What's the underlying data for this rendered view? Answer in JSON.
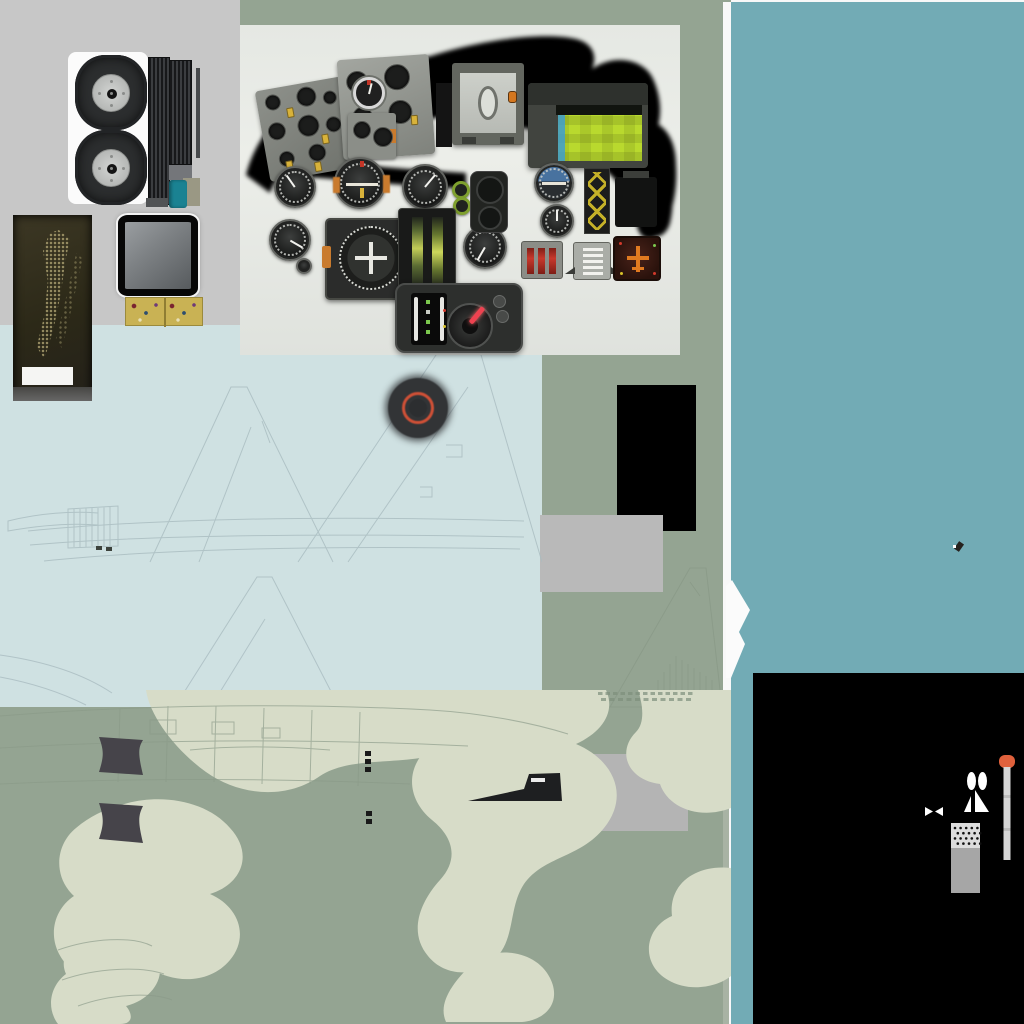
{
  "meta": {
    "type": "texture-atlas",
    "subject": "military jet aircraft model texture sprite sheet (cockpit panel photo, landing-gear wheels, camouflage skin, line-art panel drawings, antenna masts)",
    "canvas": {
      "width": 1024,
      "height": 1024
    },
    "visible_text": "none"
  },
  "colors": {
    "base_sage": "#94a492",
    "gray_panel": "#c7c7c7",
    "pale_blue": "#cfe1e2",
    "teal_column": "#72abb5",
    "white_strip": "#f8f8f8",
    "cockpit_bg": "#e9ebe6",
    "black": "#000000",
    "camo_light": "#d7dcc8",
    "line_blue": "#a9bcc0",
    "line_green": "#8a9a88",
    "olive_patch": "#36311f",
    "gold_plate": "#c9b254",
    "teal_swatch": "#1a8292",
    "tire": "#2c2e2f",
    "hub": "#c6c8c6",
    "roundel_dark": "#323436",
    "roundel_ring": "#cf5036",
    "radar_green": "#b9d92e",
    "panel_dark": "#2d2f2d",
    "knob_red": "#ee4250",
    "orange_marker": "#e0613c",
    "pole_gray": "#d6d6d6",
    "tower_top": "#dcdcdc",
    "tower_bottom": "#a6a6a6",
    "quad_dark": "#46444a",
    "rect_gray1": "#b9b9b9",
    "rect_gray2": "#b4b4b4",
    "light_sage_strip": "#a8b3a4",
    "attitude_orange": "#c97b2e",
    "yellow_knob": "#d8b23a",
    "red_bar": "#c8382c"
  },
  "atlas_sections": [
    {
      "name": "landing-gear",
      "items": [
        "main-tire",
        "main-tire",
        "ribbed-strake",
        "ribbed-strake",
        "teal-paint-swatch",
        "khaki-swatch"
      ]
    },
    {
      "name": "cockpit-photo-panel",
      "items": [
        "canopy-mask",
        "left-console",
        "main-gauge-row",
        "radar-scope-green",
        "hsi-compass",
        "bottom-knob-panel"
      ]
    },
    {
      "name": "seat-cushion-olive-patch",
      "items": [
        "ghost-figure-texture",
        "white-label"
      ]
    },
    {
      "name": "mirror-framed-screen",
      "items": [
        "black-frame",
        "gray-glass"
      ]
    },
    {
      "name": "gold-circuit-plate",
      "items": [
        "dot-pattern"
      ]
    },
    {
      "name": "pale-blue-skin-sheet",
      "items": [
        "tail-fin-line-art",
        "roundel-dark-orange-ring"
      ]
    },
    {
      "name": "camouflage-skin-sheet",
      "items": [
        "light-camo-blobs",
        "fuselage-line-art",
        "intake-ramp-quads",
        "windscreen-silhouette"
      ]
    },
    {
      "name": "solid-swatches",
      "items": [
        "black-rect",
        "gray-rect-1",
        "gray-rect-2",
        "teal-column",
        "white-divider"
      ]
    },
    {
      "name": "antenna-sprites-black-sheet",
      "items": [
        "orange-tip-pitot",
        "white-beacon",
        "bowtie-marker",
        "perforated-mast"
      ]
    }
  ],
  "cockpit": {
    "gauges": [
      {
        "name": "altimeter",
        "cx": 55,
        "cy": 162,
        "r": 21,
        "angle": -35
      },
      {
        "name": "clock",
        "cx": 50,
        "cy": 215,
        "r": 21,
        "angle": 120
      },
      {
        "name": "airspeed-indicator",
        "cx": 185,
        "cy": 162,
        "r": 23,
        "angle": 40
      },
      {
        "name": "altimeter-2",
        "cx": 245,
        "cy": 222,
        "r": 22,
        "angle": 210
      },
      {
        "name": "artificial-horizon",
        "cx": 314,
        "cy": 158,
        "r": 20,
        "style": "horizon"
      },
      {
        "name": "turn-indicator",
        "cx": 317,
        "cy": 196,
        "r": 17,
        "angle": 0
      },
      {
        "name": "engine-knob-1",
        "cx": 221,
        "cy": 165,
        "r": 9,
        "style": "green-ring"
      },
      {
        "name": "engine-knob-2",
        "cx": 222,
        "cy": 181,
        "r": 9,
        "style": "green-ring"
      },
      {
        "name": "small-knob",
        "cx": 64,
        "cy": 241,
        "r": 8
      }
    ],
    "panel_a_dials": [
      [
        8,
        6,
        16
      ],
      [
        40,
        4,
        20
      ],
      [
        66,
        12,
        14
      ],
      [
        6,
        34,
        18
      ],
      [
        36,
        32,
        22
      ],
      [
        64,
        38,
        16
      ],
      [
        12,
        64,
        16
      ],
      [
        42,
        62,
        18
      ]
    ],
    "panel_a_knobs": [
      [
        28,
        22
      ],
      [
        58,
        54
      ],
      [
        18,
        74
      ],
      [
        46,
        80
      ]
    ],
    "panel_b_dials": [
      [
        8,
        12,
        22
      ],
      [
        46,
        8,
        26
      ],
      [
        12,
        48,
        20
      ],
      [
        48,
        44,
        24
      ]
    ],
    "panel_b_knobs": [
      [
        36,
        66
      ],
      [
        70,
        60
      ]
    ],
    "panel_c_dials": [
      [
        5,
        8,
        18
      ],
      [
        25,
        14,
        20
      ]
    ]
  },
  "camouflage_blobs": [
    "M146,0 L470,0 C494,16 488,44 450,60 C406,78 354,64 320,86 C286,110 240,106 206,82 C178,62 150,28 146,0 Z",
    "M430,0 L606,0 C616,22 602,42 576,54 C614,70 630,106 604,138 C580,168 544,166 524,194 C508,218 516,250 494,270 C474,288 444,286 428,266 C408,242 420,212 440,190 C460,168 452,146 432,130 C408,110 406,82 424,62 C440,44 434,20 430,0 Z",
    "M118,116 C158,102 206,110 230,138 C254,164 242,194 210,204 C238,216 250,246 230,270 C210,294 174,294 150,278 C126,298 90,298 70,278 C46,256 50,222 74,206 C54,188 54,156 76,138 C90,126 104,120 118,116 Z",
    "M94,244 C122,236 150,246 158,268 C166,290 150,310 126,316 C134,326 132,334 120,334 L58,334 C46,318 50,296 66,284 C58,266 72,250 94,244 Z",
    "M638,0 L731,0 L731,118 C700,130 668,118 660,94 C628,90 616,62 636,42 C646,32 642,12 638,0 Z",
    "M731,178 C696,174 668,194 672,226 C644,238 640,274 668,290 C688,302 716,298 731,286 Z",
    "M478,268 C506,256 538,264 550,288 C562,312 546,330 522,332 L446,332 C438,314 450,294 478,268 Z"
  ],
  "bottom_line_art": [
    "M0,26 C120,16 280,12 430,20 C480,23 530,32 568,44",
    "M0,58 C140,50 300,48 468,56",
    "M0,94 C130,88 270,88 410,94",
    "M150,30 h26 v14 h-26 Z M212,32 h22 v12 h-22 Z M262,38 h18 v10 h-18 Z",
    "M120,18 L118,92 M168,16 L166,92 M216,16 L214,92 M264,18 L262,94 M312,20 L310,94 M360,22 L358,96",
    "M58,260 C92,248 132,246 152,256 M62,290 C96,278 140,276 164,284 M78,316 C110,304 152,302 172,310",
    "M190,60 C230,56 280,56 330,60"
  ],
  "bottom_solids": [
    {
      "d": "M99,47 L143,50 C138,58 138,64 143,85 L99,82 C104,66 104,61 99,47 Z",
      "f": "#46444a"
    },
    {
      "d": "M99,113 L143,116 C138,126 138,132 143,153 L99,149 C104,134 104,128 99,113 Z",
      "f": "#46444a"
    },
    {
      "d": "M468,111 L524,99 L529,84 L560,83 L562,111 Z",
      "f": "#1e1f21"
    },
    {
      "d": "M531,88 h14 v4 h-14 Z",
      "f": "#ebebeb"
    },
    {
      "d": "M365,61 h6 v5 h-6 Z M365,69 h6 v5 h-6 Z M365,77 h6 v5 h-6 Z M366,121 h6 v5 h-6 Z M366,129 h6 v5 h-6 Z",
      "f": "#191919"
    }
  ],
  "stencil_rows": [
    {
      "x0": 598,
      "y": 2,
      "count": 13,
      "dx": 7.5,
      "w": 4.5,
      "h": 3
    },
    {
      "x0": 601,
      "y": 8,
      "count": 11,
      "dx": 8.5,
      "w": 5,
      "h": 3
    }
  ],
  "blue_line_art": [
    "M150,237 L231,62 L247,62 L333,237",
    "M199,237 L251,102 M262,96 L270,118",
    "M68,184 L118,181 L118,221 L68,223 Z M74,184 L74,222 M80,184 L80,222 M86,183 L86,222 M92,183 L92,221 M98,182 L98,221 M104,182 L104,221 M110,182 L110,221",
    "M28,206 C150,194 320,190 524,196 M30,220 C150,210 320,208 524,212 M44,236 C160,224 330,220 520,224",
    "M8,196 C40,188 72,186 98,188 L98,200 C72,198 42,200 8,206 Z",
    "M298,237 L452,6 L474,6 L542,237 M348,237 L468,62 M446,120 h16 v12 h-16 M420,162 h12 v10 h-12",
    "M176,380 L257,252 L272,252 L338,380 M212,380 L265,294",
    "M0,330 C42,336 82,348 112,368 M0,352 C32,358 62,368 86,380"
  ],
  "blue_solids": [
    {
      "d": "M96,221 h6 v4 h-6 Z M106,222 h6 v4 h-6 Z",
      "f": "#3c423c"
    }
  ],
  "sage_fin_art": [
    "M70,155 L150,16 L166,16 L182,155",
    "M58,155 L188,155",
    "M118,155 L118,128 M124,155 L124,120 M130,155 L130,112 M136,155 L136,104 M142,155 L142,108 M148,155 L148,112 M154,155 L154,116 M160,155 L160,120 M166,155 L166,124 M172,155 L172,128",
    "M150,30 L160,44"
  ],
  "mast_dots": {
    "rows": 4,
    "cols": 5,
    "x0": 35,
    "y0": 78,
    "dx": 5.6,
    "dy": 5.2,
    "r": 1.3
  }
}
